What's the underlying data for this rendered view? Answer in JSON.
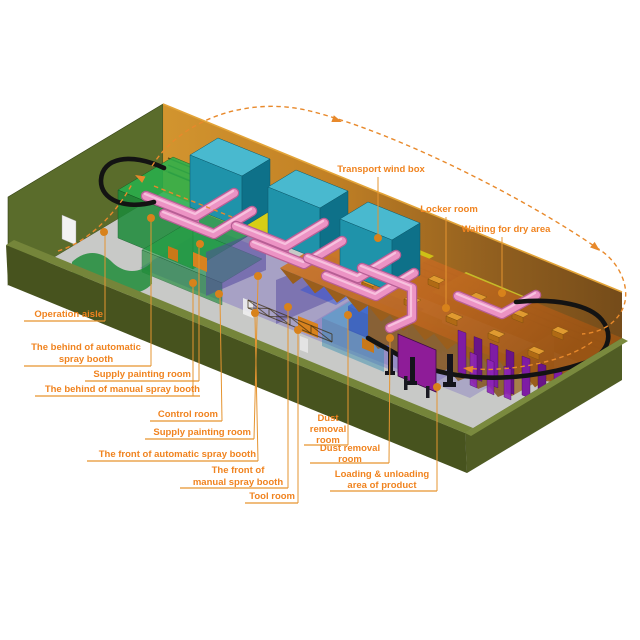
{
  "diagram": {
    "type": "isometric-factory-layout",
    "accent_color": "#F0831F",
    "flow_path_color": "#E8892B",
    "conveyor_color": "#131313",
    "palette": {
      "outer_wall_green": "#47531E",
      "wall_top_green": "#75853A",
      "back_wall_orange": "#C98A1E",
      "back_wall_brown": "#7A4A14",
      "floor_gray": "#C8C9C7",
      "aisle_purple": "#8A7AC8",
      "booth_green": "#1B8A38",
      "wind_box_teal": "#1F93AA",
      "duct_pink": "#EC93C4",
      "roof_orange": "#C8742A",
      "product_purple": "#7F1CA4",
      "panel_magenta": "#8E1C98",
      "supply_room_yellow": "#D8D414"
    },
    "icons": [
      "flow-arrow-icon",
      "callout-dot-icon"
    ],
    "callouts": [
      {
        "id": "operation-aisle",
        "lines": [
          "Operation aisle"
        ],
        "anchor": "end",
        "tx": 103,
        "ty": 317,
        "lh": 12,
        "underline": [
          24,
          321,
          105,
          321
        ],
        "leader": [
          [
            105,
            321
          ],
          [
            105,
            236
          ]
        ],
        "dot": [
          104,
          232
        ]
      },
      {
        "id": "behind-automatic-spray-booth",
        "lines": [
          "The behind of automatic",
          "spray booth"
        ],
        "anchor": "middle",
        "tx": 86,
        "ty": 350,
        "lh": 12,
        "underline": [
          24,
          366,
          151,
          366
        ],
        "leader": [
          [
            151,
            366
          ],
          [
            151,
            222
          ]
        ],
        "dot": [
          151,
          218
        ]
      },
      {
        "id": "supply-painting-room-back",
        "lines": [
          "Supply painting room"
        ],
        "anchor": "end",
        "tx": 191,
        "ty": 377,
        "lh": 12,
        "underline": [
          85,
          381,
          199,
          381
        ],
        "leader": [
          [
            199,
            381
          ],
          [
            199,
            248
          ]
        ],
        "dot": [
          200,
          244
        ]
      },
      {
        "id": "behind-manual-spray-booth",
        "lines": [
          "The behind of manual spray booth"
        ],
        "anchor": "end",
        "tx": 200,
        "ty": 392,
        "lh": 12,
        "underline": [
          35,
          396,
          200,
          396
        ],
        "leader": [
          [
            193,
            396
          ],
          [
            193,
            287
          ]
        ],
        "dot": [
          193,
          283
        ]
      },
      {
        "id": "control-room",
        "lines": [
          "Control room"
        ],
        "anchor": "end",
        "tx": 218,
        "ty": 417,
        "lh": 12,
        "underline": [
          150,
          421,
          222,
          421
        ],
        "leader": [
          [
            222,
            421
          ],
          [
            220,
            298
          ]
        ],
        "dot": [
          219,
          294
        ]
      },
      {
        "id": "supply-painting-room-front",
        "lines": [
          "Supply painting room"
        ],
        "anchor": "end",
        "tx": 251,
        "ty": 435,
        "lh": 12,
        "underline": [
          145,
          439,
          254,
          439
        ],
        "leader": [
          [
            254,
            439
          ],
          [
            258,
            280
          ]
        ],
        "dot": [
          258,
          276
        ]
      },
      {
        "id": "front-automatic-spray-booth",
        "lines": [
          "The front of automatic spray booth"
        ],
        "anchor": "end",
        "tx": 256,
        "ty": 457,
        "lh": 12,
        "underline": [
          87,
          461,
          258,
          461
        ],
        "leader": [
          [
            258,
            461
          ],
          [
            255,
            317
          ]
        ],
        "dot": [
          255,
          313
        ]
      },
      {
        "id": "front-manual-spray-booth",
        "lines": [
          "The  front of",
          "manual spray booth"
        ],
        "anchor": "middle",
        "tx": 238,
        "ty": 473,
        "lh": 12,
        "underline": [
          180,
          488,
          288,
          488
        ],
        "leader": [
          [
            288,
            488
          ],
          [
            288,
            311
          ]
        ],
        "dot": [
          288,
          307
        ]
      },
      {
        "id": "tool-room",
        "lines": [
          "Tool room"
        ],
        "anchor": "end",
        "tx": 295,
        "ty": 499,
        "lh": 12,
        "underline": [
          245,
          503,
          298,
          503
        ],
        "leader": [
          [
            298,
            503
          ],
          [
            298,
            334
          ]
        ],
        "dot": [
          298,
          330
        ]
      },
      {
        "id": "dust-removal-room-1",
        "lines": [
          "Dust",
          "removal",
          "room"
        ],
        "anchor": "middle",
        "tx": 328,
        "ty": 421,
        "lh": 11,
        "underline": [
          304,
          445,
          348,
          445
        ],
        "leader": [
          [
            348,
            445
          ],
          [
            348,
            319
          ]
        ],
        "dot": [
          348,
          315
        ]
      },
      {
        "id": "dust-removal-room-2",
        "lines": [
          "Dust removal",
          "room"
        ],
        "anchor": "middle",
        "tx": 350,
        "ty": 451,
        "lh": 11,
        "underline": [
          310,
          463,
          389,
          463
        ],
        "leader": [
          [
            389,
            463
          ],
          [
            390,
            342
          ]
        ],
        "dot": [
          390,
          338
        ]
      },
      {
        "id": "loading-unloading-area",
        "lines": [
          "Loading & unloading",
          "area of product"
        ],
        "anchor": "middle",
        "tx": 382,
        "ty": 477,
        "lh": 11,
        "underline": [
          330,
          491,
          437,
          491
        ],
        "leader": [
          [
            437,
            491
          ],
          [
            437,
            391
          ]
        ],
        "dot": [
          437,
          387
        ]
      },
      {
        "id": "transport-wind-box",
        "lines": [
          "Transport wind box"
        ],
        "anchor": "middle",
        "tx": 381,
        "ty": 172,
        "lh": 12,
        "underline": null,
        "leader": [
          [
            378,
            177
          ],
          [
            378,
            234
          ]
        ],
        "dot": [
          378,
          238
        ]
      },
      {
        "id": "locker-room",
        "lines": [
          "Locker room"
        ],
        "anchor": "middle",
        "tx": 449,
        "ty": 212,
        "lh": 12,
        "underline": null,
        "leader": [
          [
            446,
            217
          ],
          [
            446,
            304
          ]
        ],
        "dot": [
          446,
          308
        ]
      },
      {
        "id": "waiting-for-dry-area",
        "lines": [
          "Waiting for dry area"
        ],
        "anchor": "middle",
        "tx": 506,
        "ty": 232,
        "lh": 12,
        "underline": null,
        "leader": [
          [
            502,
            237
          ],
          [
            502,
            289
          ]
        ],
        "dot": [
          502,
          293
        ]
      }
    ]
  }
}
